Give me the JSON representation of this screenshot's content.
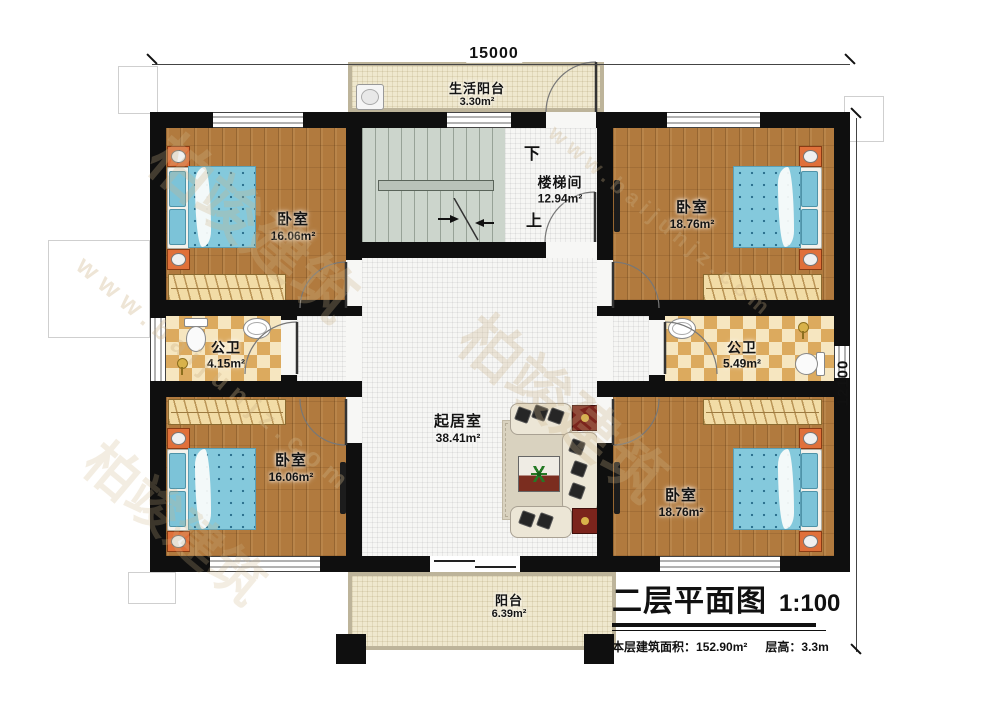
{
  "watermark": {
    "brand": "柏竣建筑",
    "site": "www.baijunjz.com"
  },
  "dimensions": {
    "width": "15000",
    "height": "12100"
  },
  "rooms": {
    "life_balcony": {
      "name": "生活阳台",
      "area": "3.30m²"
    },
    "stairwell": {
      "name": "楼梯间",
      "area": "12.94m²",
      "down": "下",
      "up": "上"
    },
    "bedroom_tl": {
      "name": "卧室",
      "area": "16.06m²"
    },
    "bedroom_tr": {
      "name": "卧室",
      "area": "18.76m²"
    },
    "bath_left": {
      "name": "公卫",
      "area": "4.15m²"
    },
    "bath_right": {
      "name": "公卫",
      "area": "5.49m²"
    },
    "living": {
      "name": "起居室",
      "area": "38.41m²"
    },
    "bedroom_bl": {
      "name": "卧室",
      "area": "16.06m²"
    },
    "bedroom_br": {
      "name": "卧室",
      "area": "18.76m²"
    },
    "balcony": {
      "name": "阳台",
      "area": "6.39m²"
    }
  },
  "title_block": {
    "title": "二层平面图",
    "scale": "1:100",
    "floor_area_label": "本层建筑面积：",
    "floor_area": "152.90m²",
    "story_height_label": "层高：",
    "story_height": "3.3m"
  }
}
